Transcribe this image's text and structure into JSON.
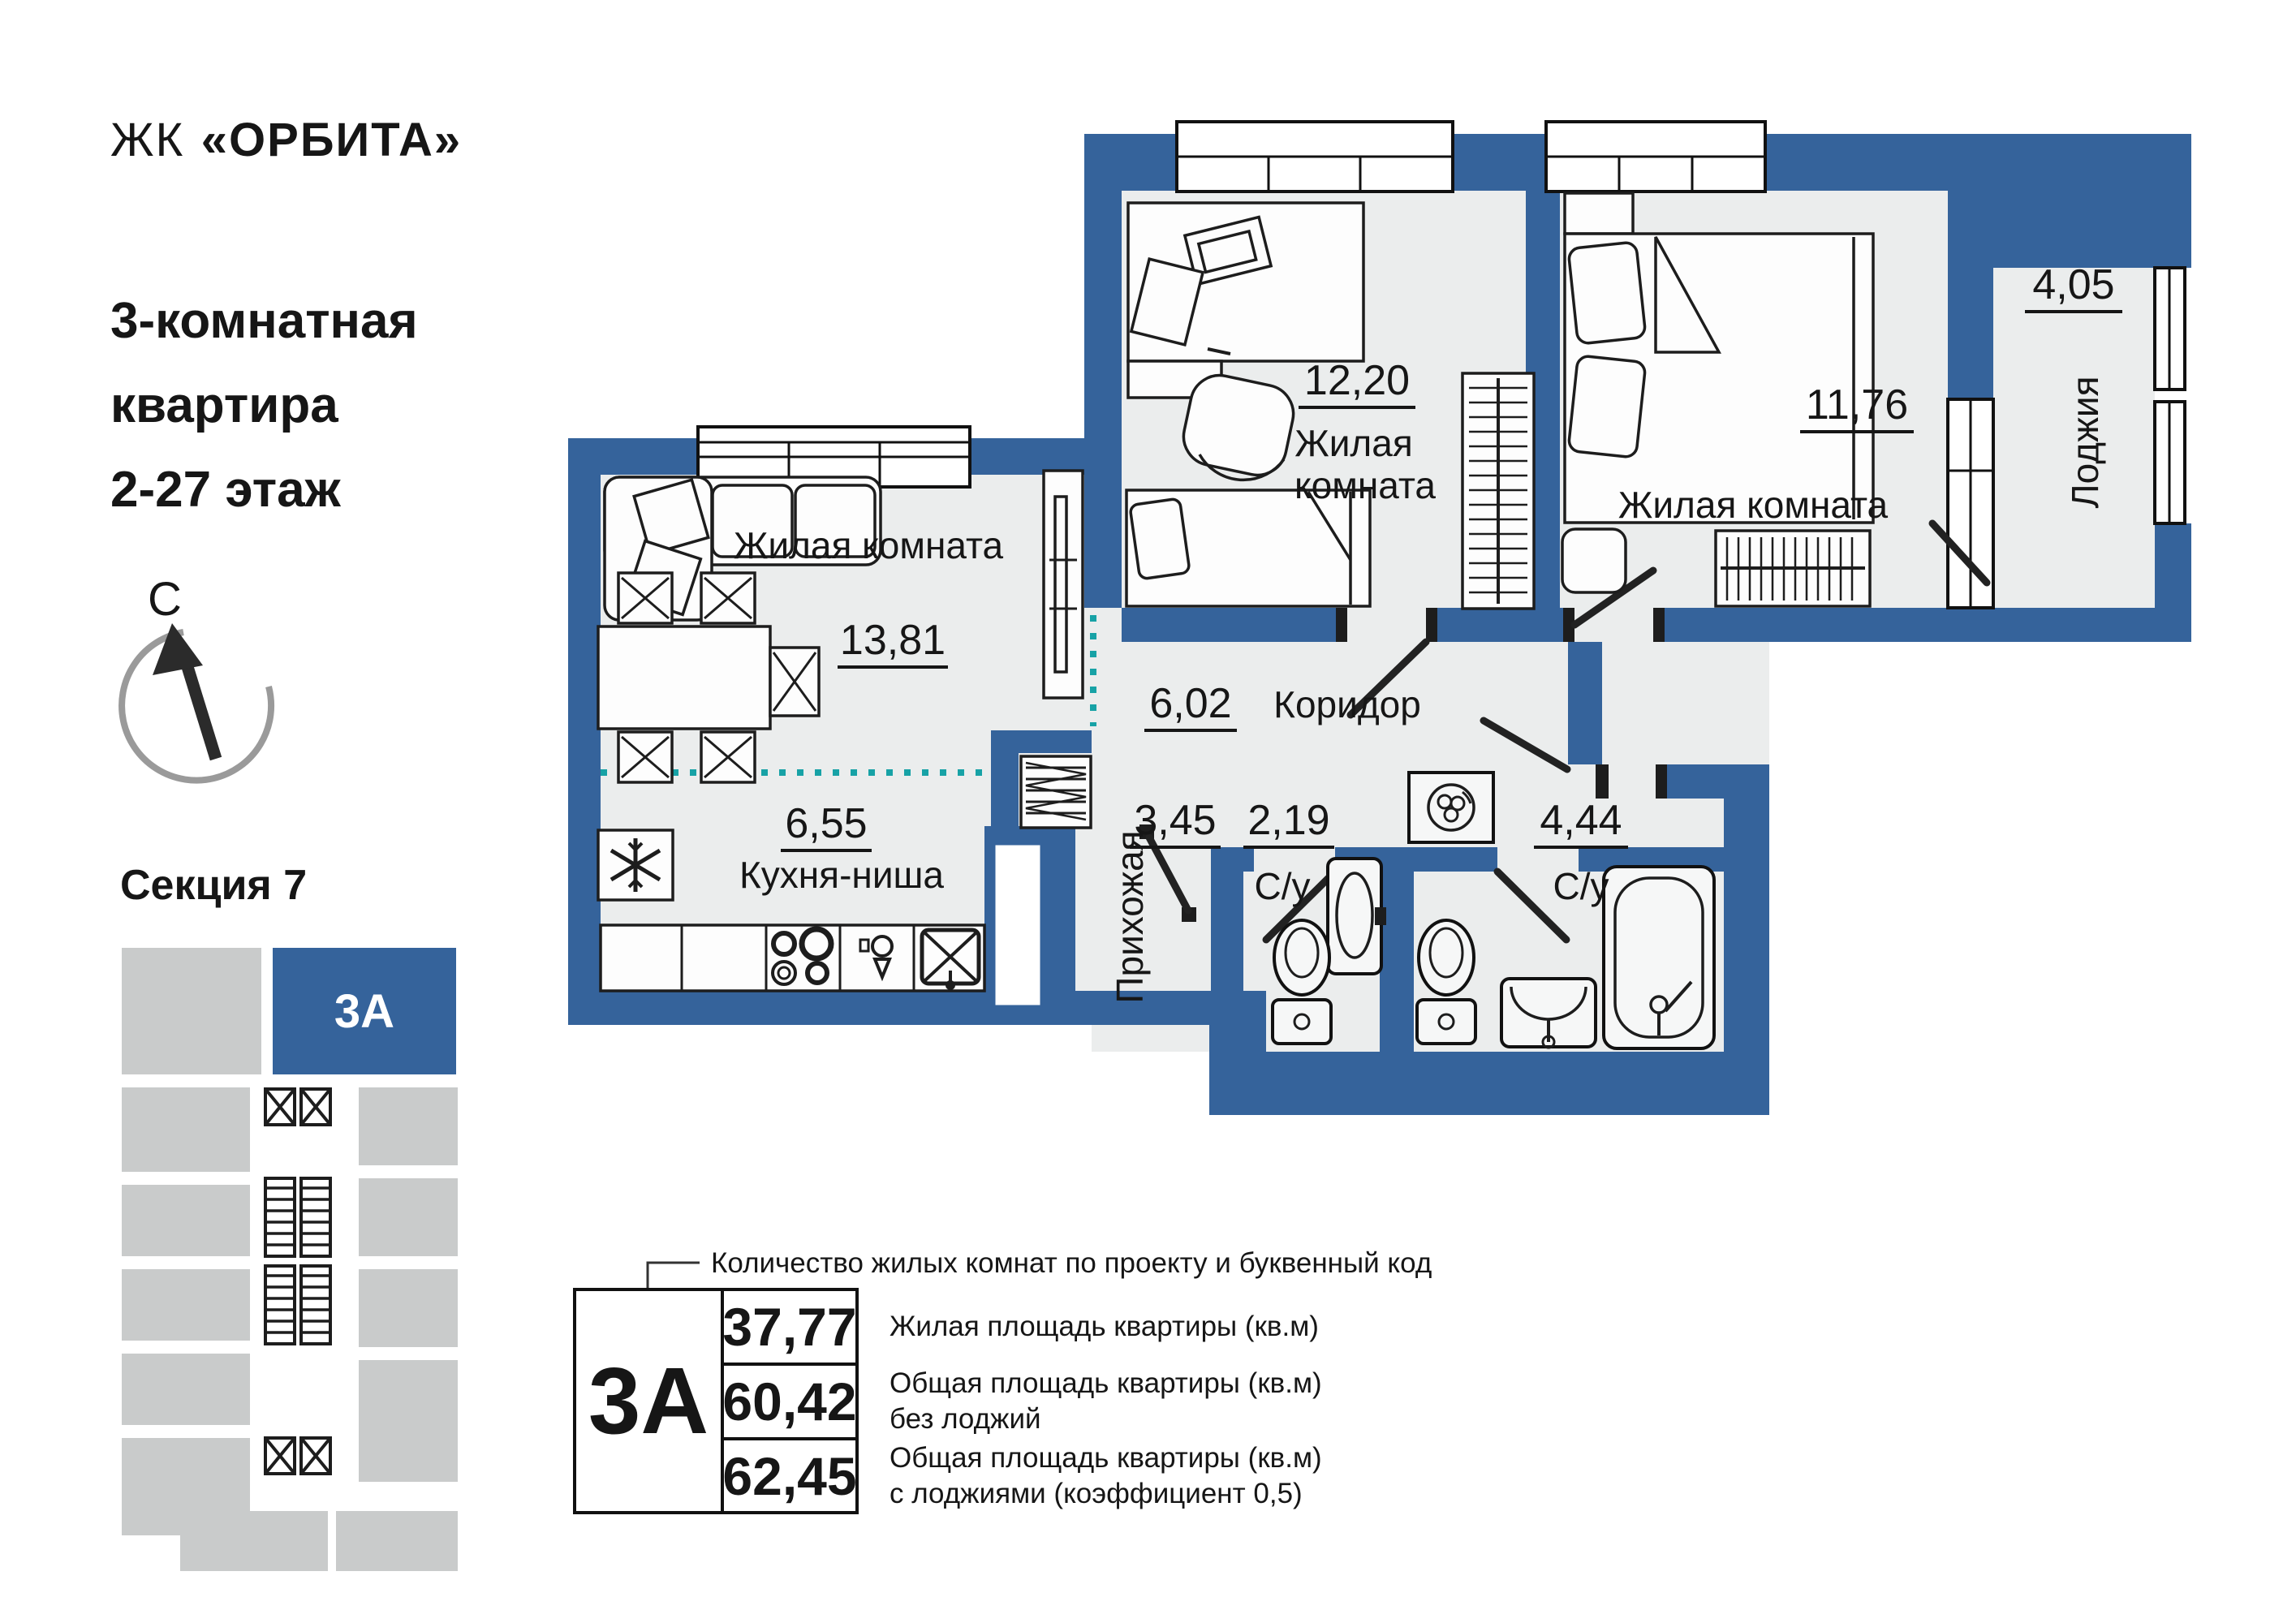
{
  "colors": {
    "wall_blue": "#35639B",
    "room_fill": "#EBEDED",
    "zone_teal": "#17A2A6",
    "minimap_gray": "#C9CBCB",
    "text": "#161616"
  },
  "sidebar": {
    "project_prefix": "ЖК",
    "project_name": "«ОРБИТА»",
    "subtitle_lines": [
      "3-комнатная",
      "квартира",
      "2-27 этаж"
    ],
    "compass_label": "С",
    "section_title": "Секция 7",
    "minimap_unit_label": "3А"
  },
  "plan": {
    "rooms": [
      {
        "key": "living",
        "name": "Жилая комната",
        "area": "13,81"
      },
      {
        "key": "kitchen",
        "name": "Кухня-ниша",
        "area": "6,55"
      },
      {
        "key": "bedroom-middle",
        "name_line1": "Жилая",
        "name_line2": "комната",
        "area": "12,20"
      },
      {
        "key": "bedroom-right",
        "name": "Жилая комната",
        "area": "11,76"
      },
      {
        "key": "loggia",
        "name": "Лоджия",
        "area": "4,05"
      },
      {
        "key": "corridor",
        "name": "Коридор",
        "area": "6,02"
      },
      {
        "key": "hallway",
        "name": "Прихожая",
        "area": "3,45"
      },
      {
        "key": "bathroom-small",
        "name": "С/у",
        "area": "2,19"
      },
      {
        "key": "bathroom-large",
        "name": "С/у",
        "area": "4,44"
      }
    ]
  },
  "legend": {
    "callout": "Количество жилых комнат по проекту и буквенный код",
    "unit_code": "3А",
    "rows": [
      {
        "value": "37,77",
        "label_lines": [
          "Жилая площадь квартиры (кв.м)",
          ""
        ]
      },
      {
        "value": "60,42",
        "label_lines": [
          "Общая площадь квартиры (кв.м)",
          "без лоджий"
        ]
      },
      {
        "value": "62,45",
        "label_lines": [
          "Общая площадь квартиры (кв.м)",
          "с лоджиями (коэффициент 0,5)"
        ]
      }
    ]
  }
}
